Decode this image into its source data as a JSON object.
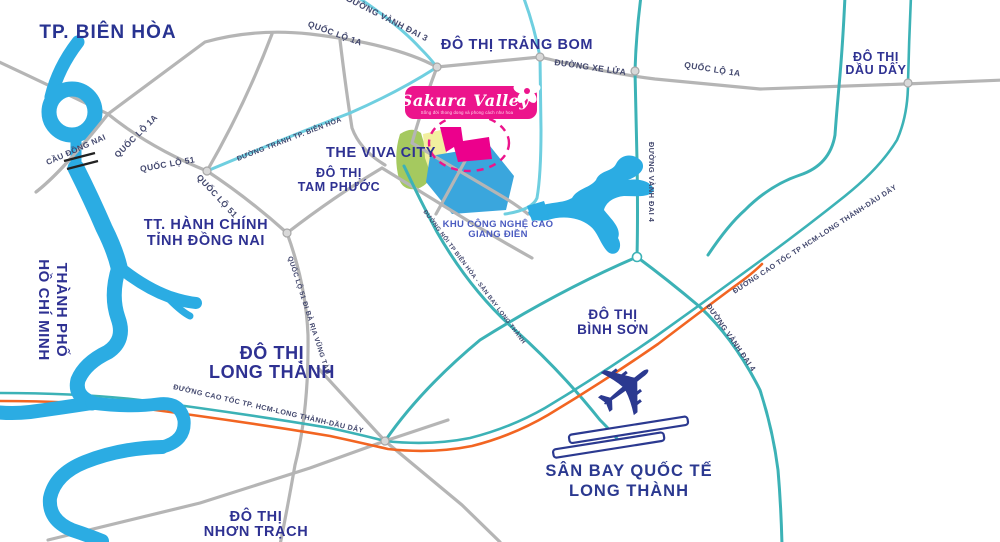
{
  "logo": {
    "title": "Sakura Valley",
    "tagline": "Sống đời thong dong và phong cách như hoa"
  },
  "areas": {
    "bien_hoa": "TP. BIÊN HÒA",
    "trang_bom": "ĐÔ THỊ TRẢNG BOM",
    "dau_day_l1": "ĐÔ THỊ",
    "dau_day_l2": "DẦU DÂY",
    "viva_city": "THE VIVA CITY",
    "tam_phuoc_l1": "ĐÔ THỊ",
    "tam_phuoc_l2": "TAM PHƯỚC",
    "hanh_chinh_l1": "TT. HÀNH CHÍNH",
    "hanh_chinh_l2": "TỈNH ĐỒNG NAI",
    "hcmc_l1": "THÀNH PHỐ",
    "hcmc_l2": "HỒ CHÍ MINH",
    "long_thanh_l1": "ĐÔ THỊ",
    "long_thanh_l2": "LONG THÀNH",
    "binh_son_l1": "ĐÔ THỊ",
    "binh_son_l2": "BÌNH SƠN",
    "nhon_trach_l1": "ĐÔ THỊ",
    "nhon_trach_l2": "NHƠN TRẠCH",
    "giang_dien_l1": "KHU CÔNG NGHỆ CAO",
    "giang_dien_l2": "GIANG ĐIỀN",
    "airport_l1": "SÂN BAY QUỐC TẾ",
    "airport_l2": "LONG THÀNH"
  },
  "roads": {
    "ql1a": "QUỐC LỘ 1A",
    "ql51": "QUỐC LỘ 51",
    "ql51_vung_tau": "QUỐC LỘ 51 ĐI BÀ RỊA VŨNG TÀU",
    "vanh_dai_3": "ĐƯỜNG VÀNH ĐAI 3",
    "vanh_dai_4": "ĐƯỜNG VÀNH ĐAI 4",
    "xe_lua": "ĐƯỜNG XE LỬA",
    "tranh_bien_hoa": "ĐƯỜNG TRÁNH TP. BIÊN HÒA",
    "noi_san_bay": "ĐƯỜNG NỐI TP BIÊN HÒA - SÂN BAY LONG THÀNH",
    "cao_toc": "ĐƯỜNG CAO TỐC TP. HCM-LONG THÀNH-DẦU DÂY",
    "cao_toc_2": "ĐƯỜNG CAO TỐC TP HCM-LONG THÀNH-DẦU DÂY",
    "cau_dong_nai": "CẦU ĐỒNG NAI"
  },
  "colors": {
    "water": "#2bace3",
    "road_gray": "#b5b5b5",
    "road_teal": "#3cb2b6",
    "road_cyan": "#6fcfe0",
    "expressway_orange": "#f26522",
    "brand_pink": "#ec148c",
    "site_pink": "#ec008c",
    "dev_blue": "#3aa6dd",
    "dev_green": "#a5c95f",
    "dev_yellow": "#f2ef9f",
    "navy_text": "#2e3192"
  }
}
